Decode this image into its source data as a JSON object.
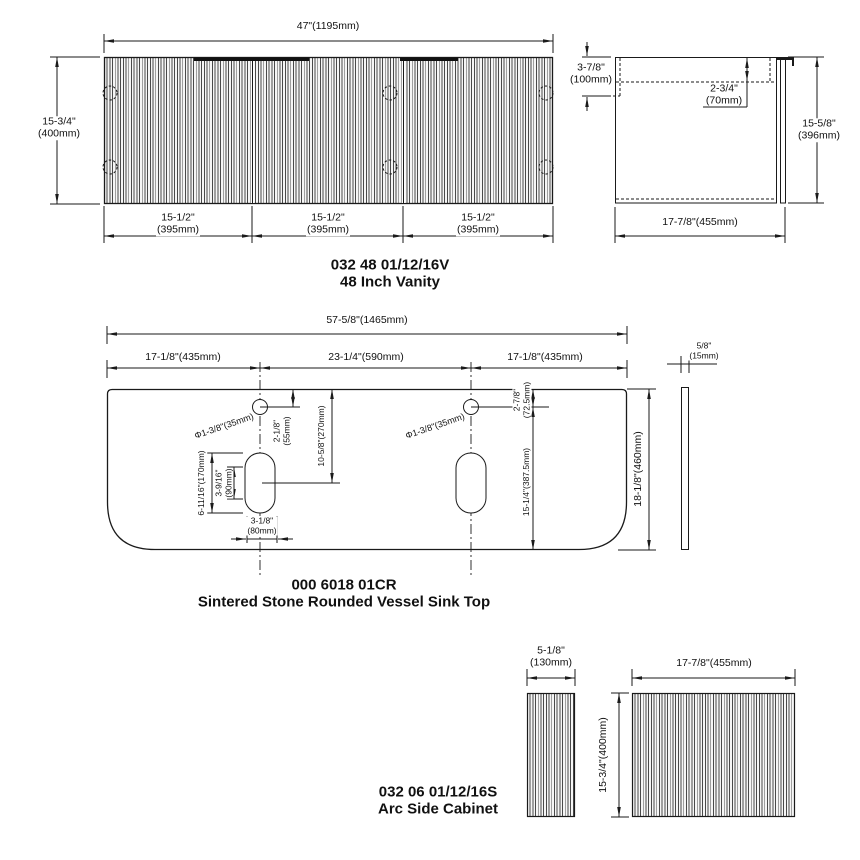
{
  "page": {
    "background": "#ffffff",
    "line_color": "#1a1a1a"
  },
  "vanity": {
    "code": "032 48 01/12/16V",
    "name": "48 Inch Vanity",
    "front": {
      "width": "47\"(1195mm)",
      "height": "15-3/4\"\n(400mm)",
      "doors": [
        {
          "w": "15-1/2\"\n(395mm)"
        },
        {
          "w": "15-1/2\"\n(395mm)"
        },
        {
          "w": "15-1/2\"\n(395mm)"
        }
      ]
    },
    "side": {
      "top_height": "3-7/8\"\n(100mm)",
      "top_inset": "2-3/4\"\n(70mm)",
      "height": "15-5/8\"\n(396mm)",
      "depth": "17-7/8\"(455mm)"
    }
  },
  "sink_top": {
    "code": "000 6018 01CR",
    "name": "Sintered Stone Rounded Vessel Sink Top",
    "width": "57-5/8\"(1465mm)",
    "left_span": "17-1/8\"(435mm)",
    "center_span": "23-1/4\"(590mm)",
    "right_span": "17-1/8\"(435mm)",
    "depth": "18-1/8\"(460mm)",
    "faucet_hole_left": "Φ1-3/8\"(35mm)",
    "faucet_hole_right": "Φ1-3/8\"(35mm)",
    "hole_left_from_top": "2-1/8\"\n(55mm)",
    "hole_right_from_top": "2-7/8\"\n(72.5mm)",
    "top_to_drain_center": "10-5/8\"(270mm)",
    "drain_length": "6-11/16\"(170mm)",
    "drain_inner": "3-9/16\"\n(90mm)",
    "drain_width": "3-1/8\"\n(80mm)",
    "hole_right_to_bottom": "15-1/4\"(387.5mm)",
    "thickness": "5/8\"\n(15mm)"
  },
  "side_cabinet": {
    "code": "032 06 01/12/16S",
    "name": "Arc Side Cabinet",
    "depth": "5-1/8\"\n(130mm)",
    "width": "17-7/8\"(455mm)",
    "height": "15-3/4\"(400mm)"
  }
}
